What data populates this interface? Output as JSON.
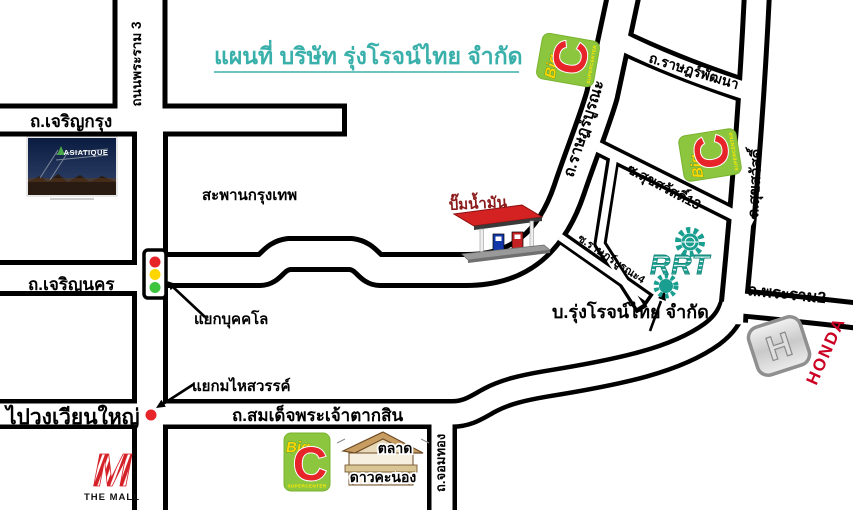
{
  "title": {
    "text": "แผนที่ บริษัท รุ่งโรจน์ไทย จำกัด",
    "color": "#3ab0ab"
  },
  "roads": {
    "rama3": "ถนนพระราม 3",
    "charoen_krung": "ถ.เจริญกรุง",
    "charoen_nakhon": "ถ.เจริญนคร",
    "taksin": "ถ.สมเด็จพระเจ้าตากสิน",
    "chomthong": "ถ.จอมทอง",
    "rat_burana": "ถ.ราษฎร์บูรณะ",
    "rat_phatthana": "ถ.ราษฎร์พัฒนา",
    "suksawat": "ถ.สุขสวัสดิ์",
    "soi_suksawat_13": "ซ.สุขสวัสดิ์13",
    "soi_rat_burana_4": "ซ.ราษฎร์บูรณะ4",
    "rama2": "ถ.พระราม2"
  },
  "junctions": {
    "bukkhalo": "แยกบุคคโล",
    "mahai_sawan": "แยกมไหสวรรค์"
  },
  "landmarks": {
    "krungthep_bridge": "สะพานกรุงเทพ",
    "gas_station": "ปั๊มน้ำมัน",
    "company": "บ.รุ่งโรจน์ไทย จำกัด",
    "to_wongwian_yai": "ไปวงเวียนใหญ่",
    "market_line1": "ตลาด",
    "market_line2": "ดาวคะนอง"
  },
  "brands": {
    "asiatique": "ASIATIQUE",
    "the_mall": "THE MALL",
    "the_mall_m": "M",
    "honda": "HONDA",
    "honda_h": "H",
    "big_c_big": "Big",
    "big_c_c": "C",
    "big_c_sub": "SUPERCENTER",
    "rrt": "RRT"
  },
  "colors": {
    "title": "#3ab0ab",
    "road_line": "#000000",
    "road_fill": "#ffffff",
    "gas_label": "#8b1a1a",
    "big_c_green": "#8cc63e",
    "big_c_red": "#e62429",
    "big_c_yellow": "#ffd800",
    "rrt_teal": "#1a9e90",
    "honda_red": "#cc0022",
    "mall_red": "#d42027",
    "traffic_red": "#e8242b",
    "traffic_yellow": "#ffd500",
    "traffic_green": "#3fc43f",
    "marker_red": "#e8242b"
  }
}
